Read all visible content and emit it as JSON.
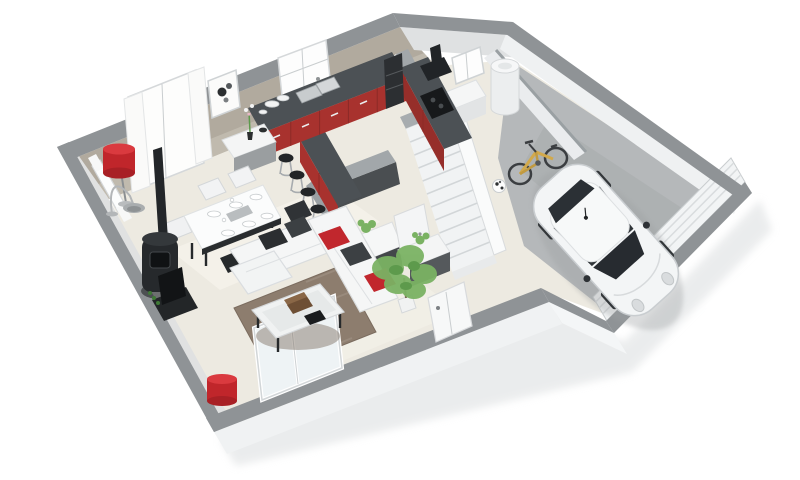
{
  "scene": {
    "kind": "3d-isometric-floor-plan-render",
    "floor": "ground-floor",
    "background": "#ffffff"
  },
  "colors": {
    "background": "#ffffff",
    "wall_top": "#8f9396",
    "wall_top_inner": "#a2a7aa",
    "exterior_face": "#f0f2f3",
    "interior_taupe": "#b1aa9e",
    "interior_light": "#e0e1e1",
    "floor_main": "#edeae1",
    "garage_floor": "#b5b8ba",
    "kitchen_red": "#a8322e",
    "kitchen_red_dark": "#962e2a",
    "counter_dark": "#4c5155",
    "anthracite": "#4a4e51",
    "black_appliance": "#212427",
    "white_furniture": "#f5f6f6",
    "cushion_red": "#c1272d",
    "cushion_dark": "#3c4043",
    "rug_brown": "#8d7d6e",
    "stair_white": "#f1f3f4",
    "car_white": "#f3f5f6",
    "car_glass": "#272b30",
    "bike_yellow": "#d2a94b",
    "plant_green": "#7ab263",
    "lamp_red": "#c0262b",
    "glass_tint": "#eef3f5"
  },
  "rooms": {
    "living_dining_kitchen": "open-plan living / dining / kitchen",
    "wc": "toilet room",
    "hall": "entrance hall",
    "staircase": "winder staircase to upper floor",
    "utility": "utility room with water heater",
    "garage": "garage"
  },
  "inventory": {
    "windows": 4,
    "bar_stools": 4,
    "dining_chairs": 6,
    "objects": [
      "corner-sofa",
      "coffee-table",
      "area-rug",
      "tv-unit",
      "wood-stove",
      "dining-table",
      "sideboard",
      "red-floor-lamp",
      "arc-lamp",
      "red-table-lamp",
      "kitchen-counter",
      "kitchen-island",
      "sink",
      "cooktop",
      "extractor-hood",
      "oven-column",
      "wc-basin",
      "wc-door",
      "water-heater",
      "freezer-box",
      "small-window",
      "picture-frame",
      "sliding-glass-door",
      "front-door",
      "garage-door",
      "white-car",
      "bicycle",
      "soccer-ball",
      "potted-plant"
    ]
  }
}
